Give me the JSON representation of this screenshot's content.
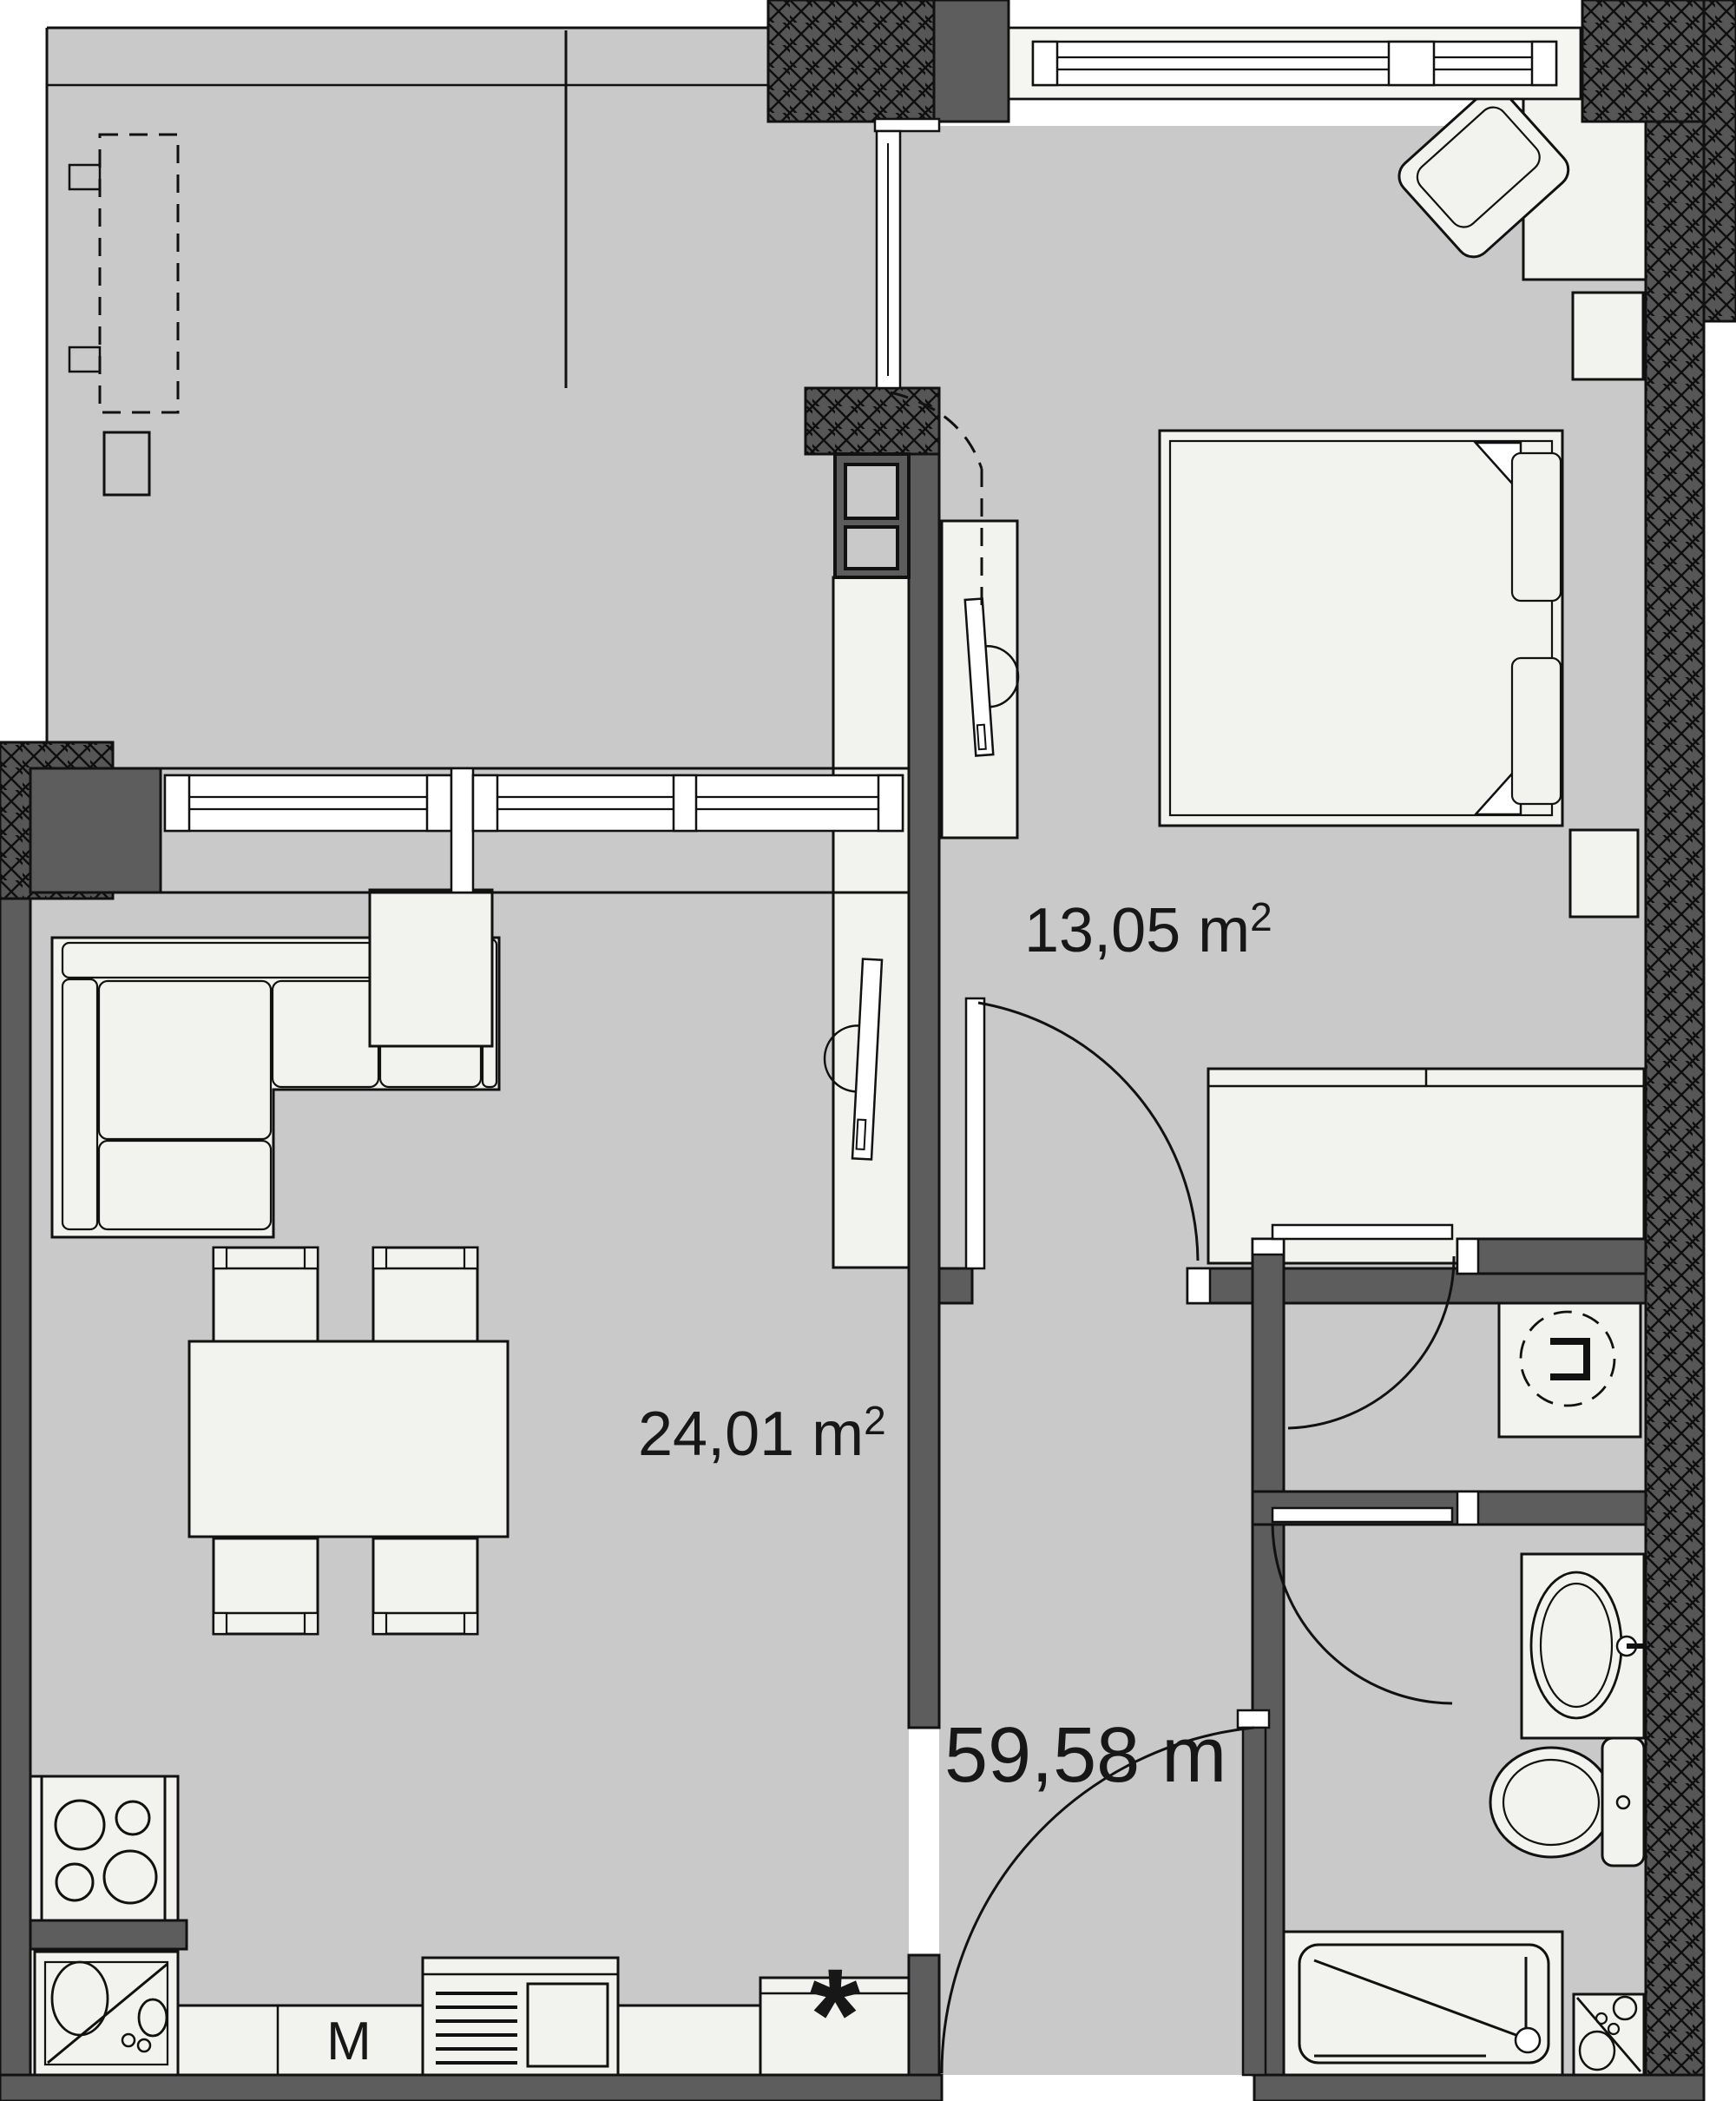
{
  "plan": {
    "kind": "apartment-floor-plan",
    "rooms": [
      {
        "id": "bedroom",
        "area": "13,05 m2"
      },
      {
        "id": "living-kitchen",
        "area": "24,01 m2"
      },
      {
        "id": "total",
        "area": "59,58 m"
      }
    ]
  },
  "labels": {
    "bedroom": {
      "text": "13,05 m",
      "sup": "2"
    },
    "living": {
      "text": "24,01 m",
      "sup": "2"
    },
    "total": {
      "text": "59,58 m",
      "sup": ""
    },
    "washing_machine": "M",
    "fridge_star": "*"
  },
  "colors": {
    "background": "#ffffff",
    "floor": "#c9c9c9",
    "furniture": "#f2f2ee",
    "wall": "#5d5d5d",
    "line": "#111111"
  }
}
